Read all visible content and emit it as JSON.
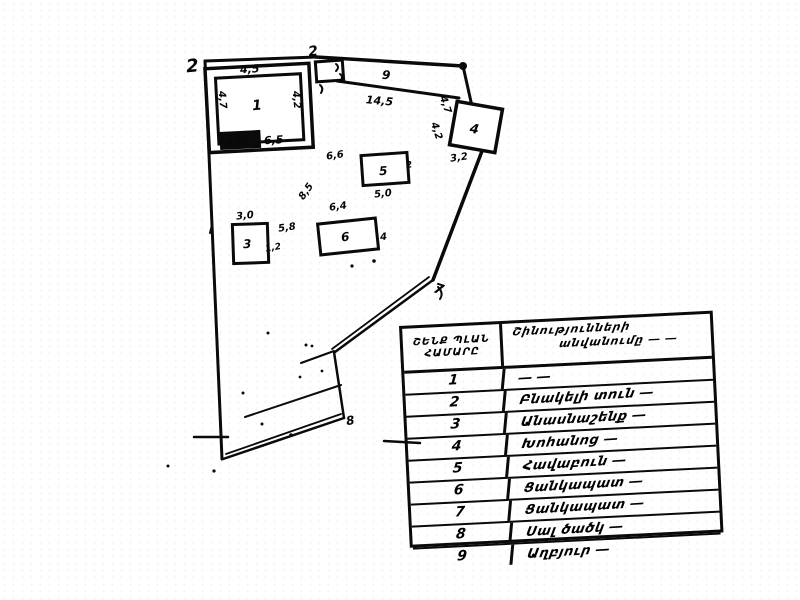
{
  "plan": {
    "vertex_labels": {
      "v2": "2",
      "v7": "7",
      "v8": "8"
    },
    "buildings": {
      "b1": {
        "label": "1",
        "dim_top": "4,5",
        "dim_left": "4,7",
        "dim_right": "4,2",
        "dim_bottom": "6,5",
        "annex_marks": "× ×"
      },
      "b2": {
        "label": "2"
      },
      "b3": {
        "label": "3",
        "dim_top": "3,0",
        "dim_right": "1,2"
      },
      "b4": {
        "label": "4",
        "dim_left": "4,2",
        "dim_bottom": "3,2"
      },
      "b5": {
        "label": "5",
        "dim_bottom": "5,0",
        "dim_right": "2"
      },
      "b6": {
        "label": "6",
        "dim_top": "6,4",
        "dim_right": "4"
      }
    },
    "dims": {
      "strip_top": "9",
      "strip_len": "14,5",
      "gap": "4,7",
      "d66": "6,6",
      "d85": "8,5",
      "d58": "5,8"
    }
  },
  "legend": {
    "header": {
      "num_line1": "ՇԵՆՔ ՊԼԱՆ",
      "num_line2": "ՀԱՄԱՐԸ",
      "name_line1": "Շինությունների",
      "name_line2": "անվանումը ― ―"
    },
    "rows": [
      {
        "num": "1",
        "name": "― ―"
      },
      {
        "num": "2",
        "name": "Բնակելի տուն ―"
      },
      {
        "num": "3",
        "name": "Անասնաշենք ―"
      },
      {
        "num": "4",
        "name": "Խոհանոց ―"
      },
      {
        "num": "5",
        "name": "Հավաբուն ―"
      },
      {
        "num": "6",
        "name": "Ցանկապատ ―"
      },
      {
        "num": "7",
        "name": "Ցանկապատ ―"
      },
      {
        "num": "8",
        "name": "Սալ ծածկ ―"
      },
      {
        "num": "9",
        "name": "Աղբյուր ―"
      }
    ]
  }
}
